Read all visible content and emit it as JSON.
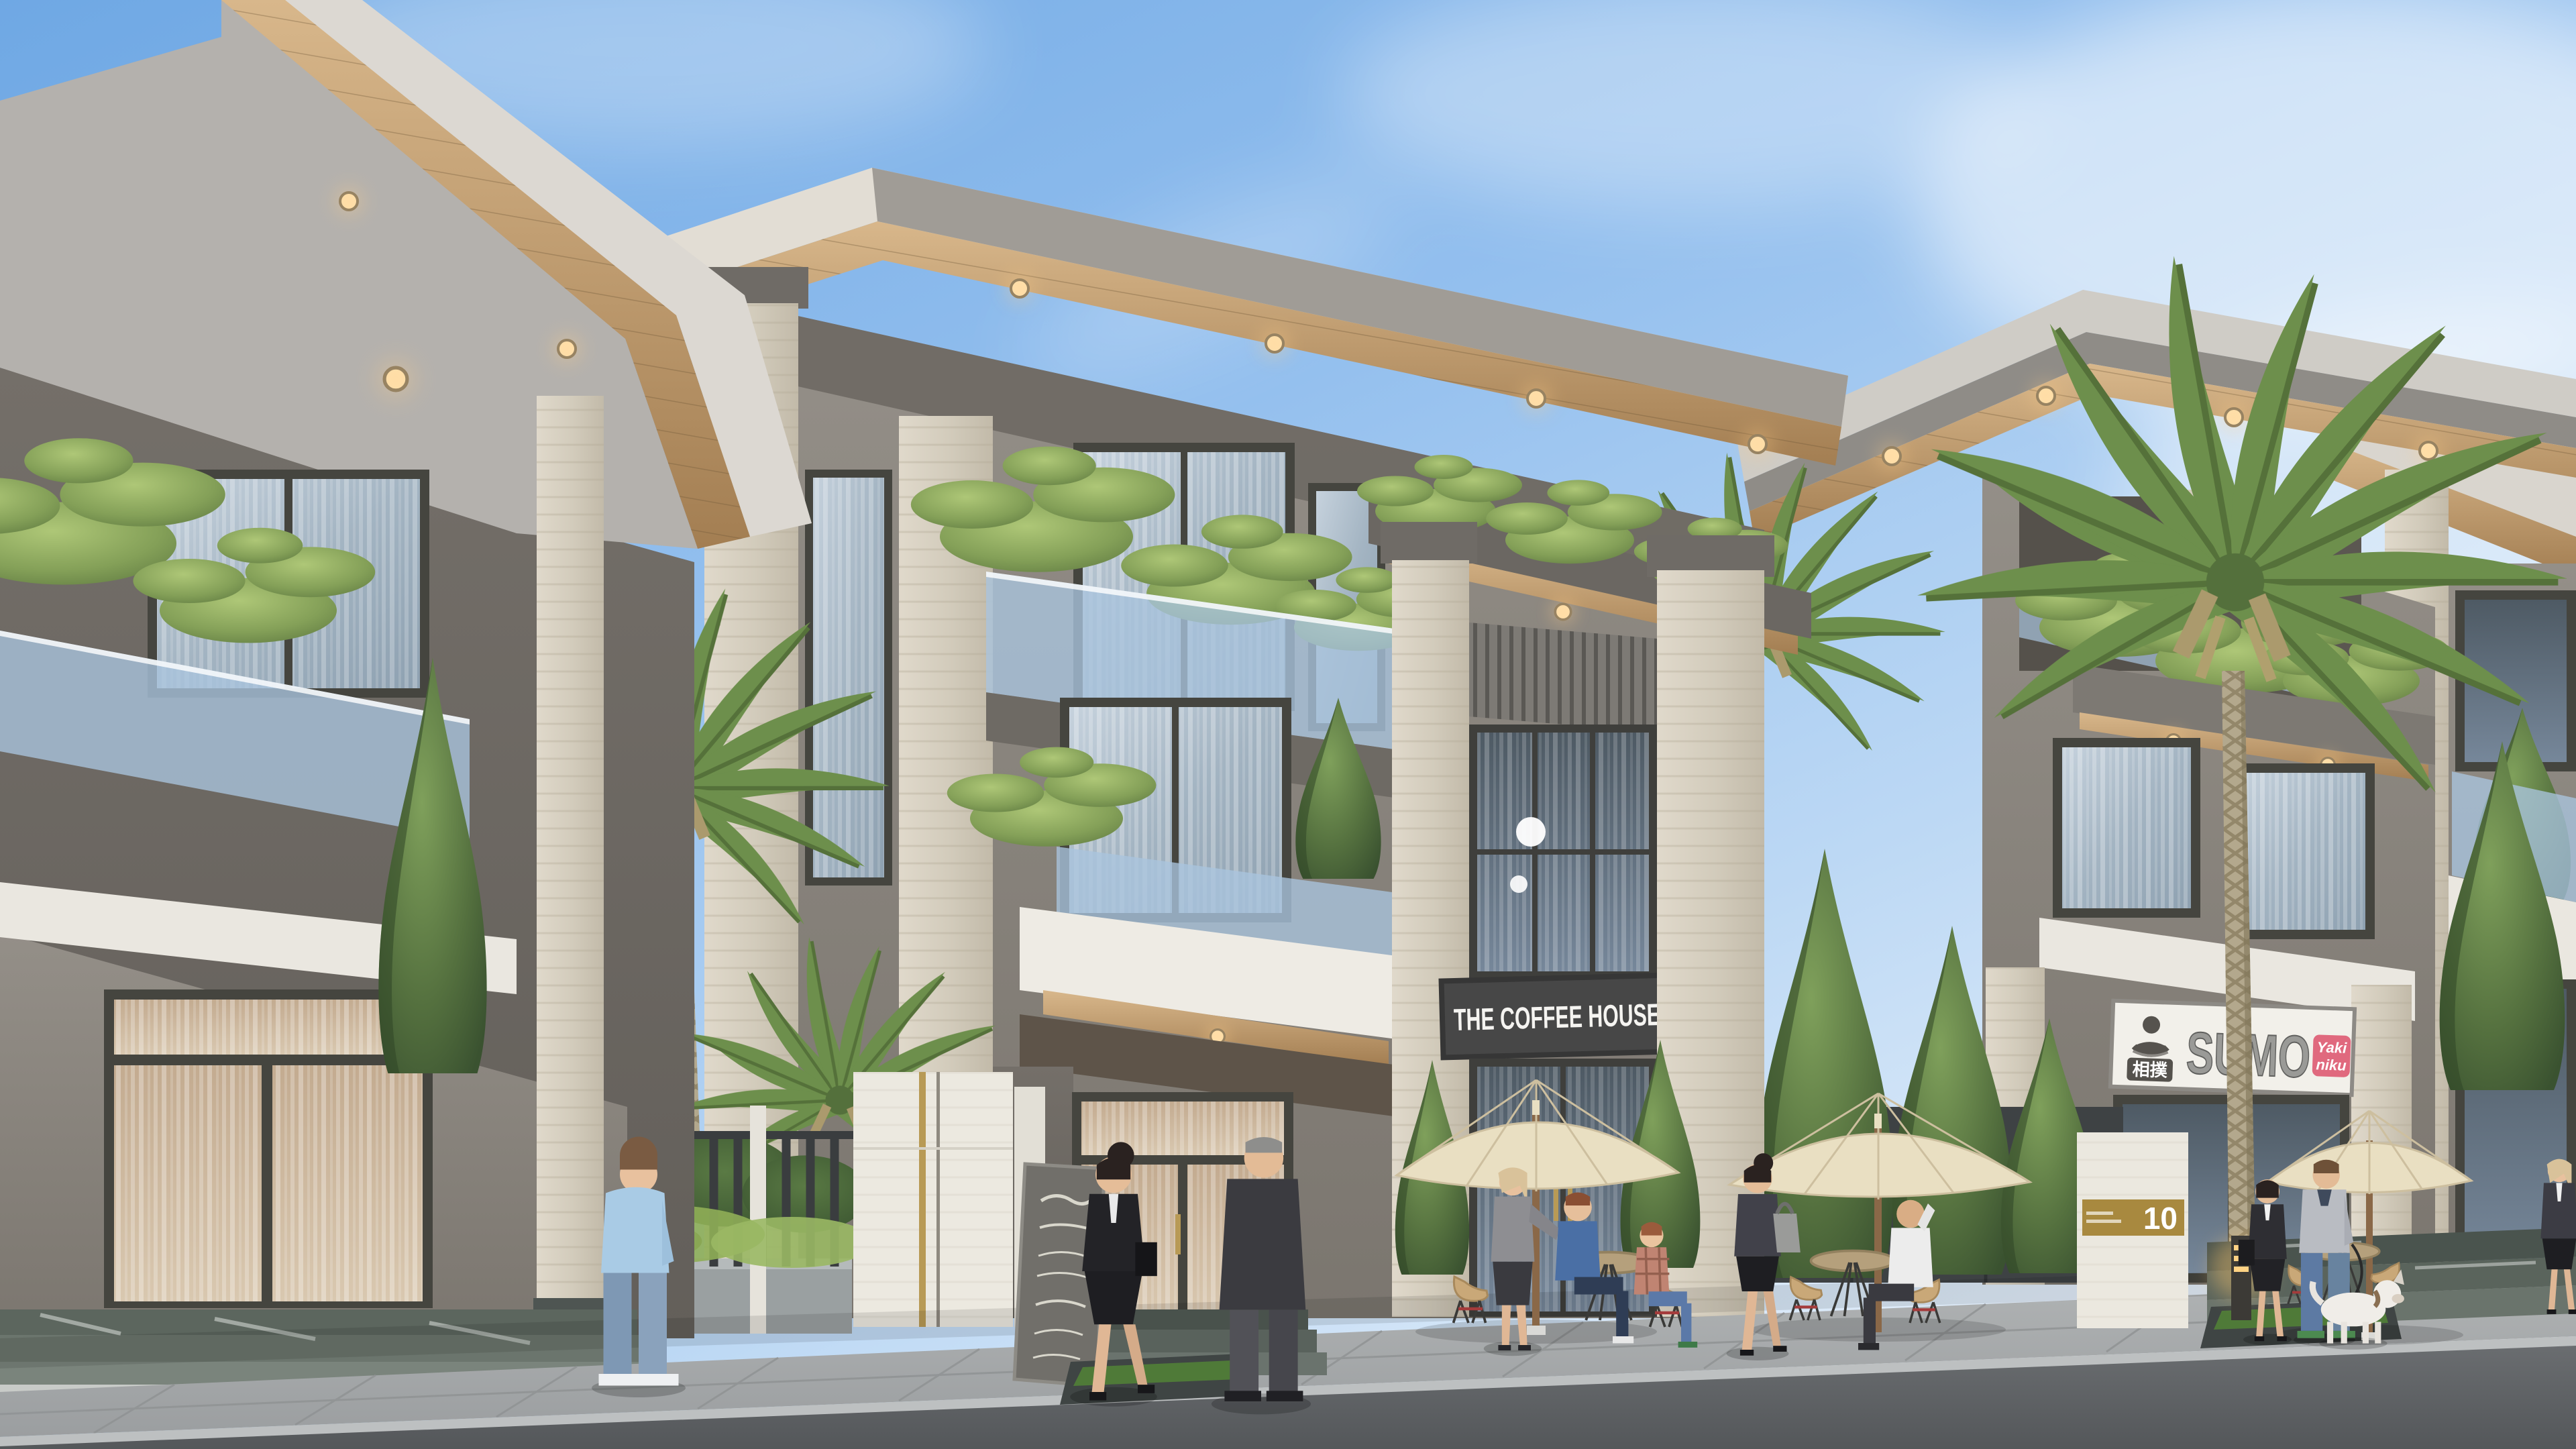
{
  "scene": {
    "type": "architectural-exterior-render",
    "description": "Daytime street view of modern three-storey shophouse villas with flat overhanging roofs, wood soffits with downlights, travertine pillars, glass balustrade balconies with bonsai pines, a coffee shop and a Japanese restaurant at street level, cafe terrace with cream umbrellas, palms and pedestrians",
    "time_of_day": "day",
    "weather": "clear with wispy clouds"
  },
  "signs": {
    "coffee_house": "THE COFFEE HOUSE",
    "sumo_brand": "SUMO",
    "sumo_japanese": "相撲",
    "yakiniku_line1": "Yaki",
    "yakiniku_line2": "niku",
    "address_plaque": "10"
  },
  "palette": {
    "sky_top": "#6fa8e4",
    "sky_horizon": "#e8f1fb",
    "wall_gray": "#8b867f",
    "travertine": "#d8d1c2",
    "wood_soffit": "#c9a87c",
    "white_trim": "#eae7e0",
    "window_frame": "#45453f",
    "glass_blue": "#a9c3dc",
    "conifer_green": "#4e6b3d",
    "pine_green": "#8aa75e",
    "umbrella_cream": "#e9dfc2",
    "road_asphalt": "#5d6063",
    "sidewalk": "#a6a9aa",
    "coffee_sign_board": "#474747",
    "sumo_sign_board": "#f2f0ea",
    "yakiniku_pink": "#e0697e",
    "plaque_gold": "#a8893f",
    "downlight_warm": "#ffd9a0"
  },
  "buildings": [
    {
      "name": "left-villa",
      "storeys": 3,
      "features": [
        "flat overhang roof",
        "wood soffit downlights",
        "balcony bonsai pines",
        "glass balustrade",
        "white slab band",
        "curtained ground window",
        "green marble entry steps"
      ]
    },
    {
      "name": "middle-villa-coffee-house",
      "storeys": 3,
      "features": [
        "corner travertine pillars",
        "roof garden pines",
        "white balcony box",
        "slatted transom panel",
        "double-height glazed shopfront",
        "dark sign board"
      ],
      "tenant_sign": "THE COFFEE HOUSE"
    },
    {
      "name": "right-villa-sumo",
      "storeys": 3,
      "features": [
        "stepped roofs",
        "balcony pines on ledge",
        "white sign board with sumo wrestler logo",
        "yakiniku badge"
      ],
      "tenant_sign": "SUMO"
    },
    {
      "name": "far-right-villa-fragment",
      "storeys": 3,
      "features": [
        "travertine pillar",
        "balcony conifer",
        "marble street steps"
      ]
    }
  ],
  "cafe_terrace": {
    "umbrellas": 3,
    "umbrella_color": "cream",
    "tables": 3,
    "chairs": "tan shell chairs with wire bases and red rods",
    "menu_board": "dark chalkboard with white script (decorative, illegible)"
  },
  "vegetation": {
    "tall_palm": 1,
    "gap_palms": 3,
    "conifers": 8,
    "balcony_bonsai_clusters": 9,
    "hedges": "dark green hedge and light ivy along metal fence"
  },
  "people": [
    {
      "name": "standing-man",
      "clothing": "light blue shirt, jeans"
    },
    {
      "name": "walking-woman-suit",
      "clothing": "black business suit, black bag"
    },
    {
      "name": "walking-man-coat",
      "clothing": "dark overcoat"
    },
    {
      "name": "standing-woman-cafe",
      "clothing": "gray top, dark skirt, blonde"
    },
    {
      "name": "sitting-man-tshirt",
      "clothing": "blue t-shirt, jeans"
    },
    {
      "name": "sitting-boy",
      "clothing": "plaid shirt, jeans"
    },
    {
      "name": "walking-woman-handbag",
      "clothing": "dark top, black skirt, gray handbag"
    },
    {
      "name": "sitting-man-phone",
      "clothing": "white shirt, dark trousers"
    },
    {
      "name": "businesswoman-palm",
      "clothing": "black suit, white shirt"
    },
    {
      "name": "man-walking-dog",
      "clothing": "gray sweater, jeans",
      "pet": "white dog on leash"
    },
    {
      "name": "woman-far-right",
      "clothing": "dark jacket, black skirt, blonde"
    }
  ],
  "street": {
    "fence": "dark vertical-bar fence with white stone posts and concrete planters",
    "gate_pillar": "white marble pillar with gold strips",
    "address_pillar": "white pillar with gold plaque",
    "bollard_light": "warm glowing bollard",
    "surfaces": [
      "large gray pavers sidewalk",
      "light curb",
      "dark asphalt road"
    ]
  }
}
